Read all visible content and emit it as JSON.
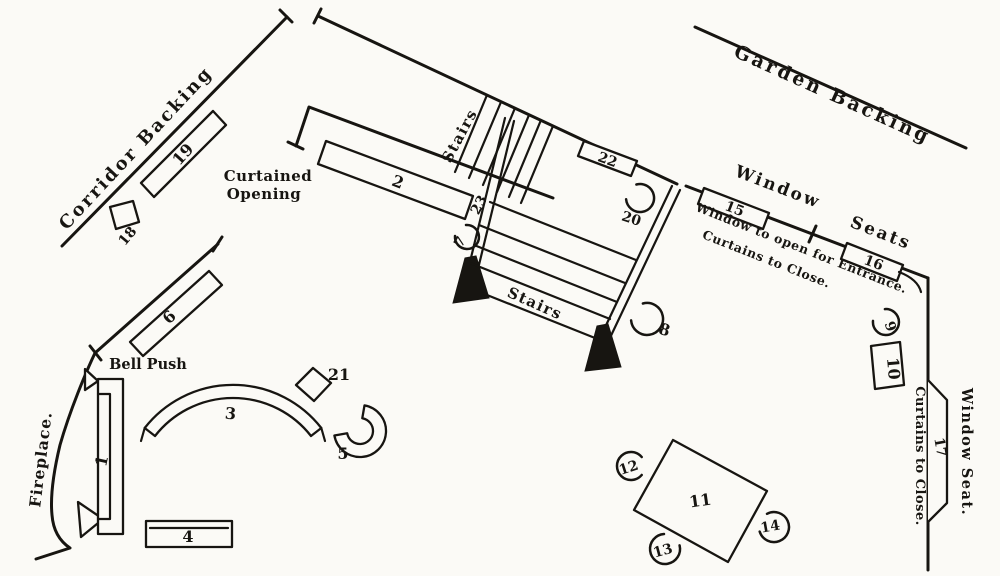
{
  "colors": {
    "ink": "#171511",
    "paper": "#fbfaf6"
  },
  "labels": {
    "corridor_backing": "Corridor Backing",
    "garden_backing": "Garden Backing",
    "curtained_opening_line1": "Curtained",
    "curtained_opening_line2": "Opening",
    "stairs_upper": "Stairs",
    "stairs_lower": "Stairs",
    "window": "Window",
    "seats": "Seats",
    "window_note_line1": "Window to open for Entrance.",
    "window_note_line2": "Curtains to Close.",
    "bell_push": "Bell Push",
    "fireplace": "Fireplace.",
    "window_seat": "Window Seat.",
    "curtains_to_close": "Curtains to Close."
  },
  "furniture": {
    "f1": "1",
    "f2": "2",
    "f3": "3",
    "f4": "4",
    "f5": "5",
    "f6": "6",
    "f7": "7",
    "f8": "8",
    "f9": "9",
    "f10": "10",
    "f11": "11",
    "f12": "12",
    "f13": "13",
    "f14": "14",
    "f15": "15",
    "f16": "16",
    "f17": "17",
    "f18": "18",
    "f19": "19",
    "f20": "20",
    "f21": "21",
    "f22": "22",
    "f23": "23"
  }
}
